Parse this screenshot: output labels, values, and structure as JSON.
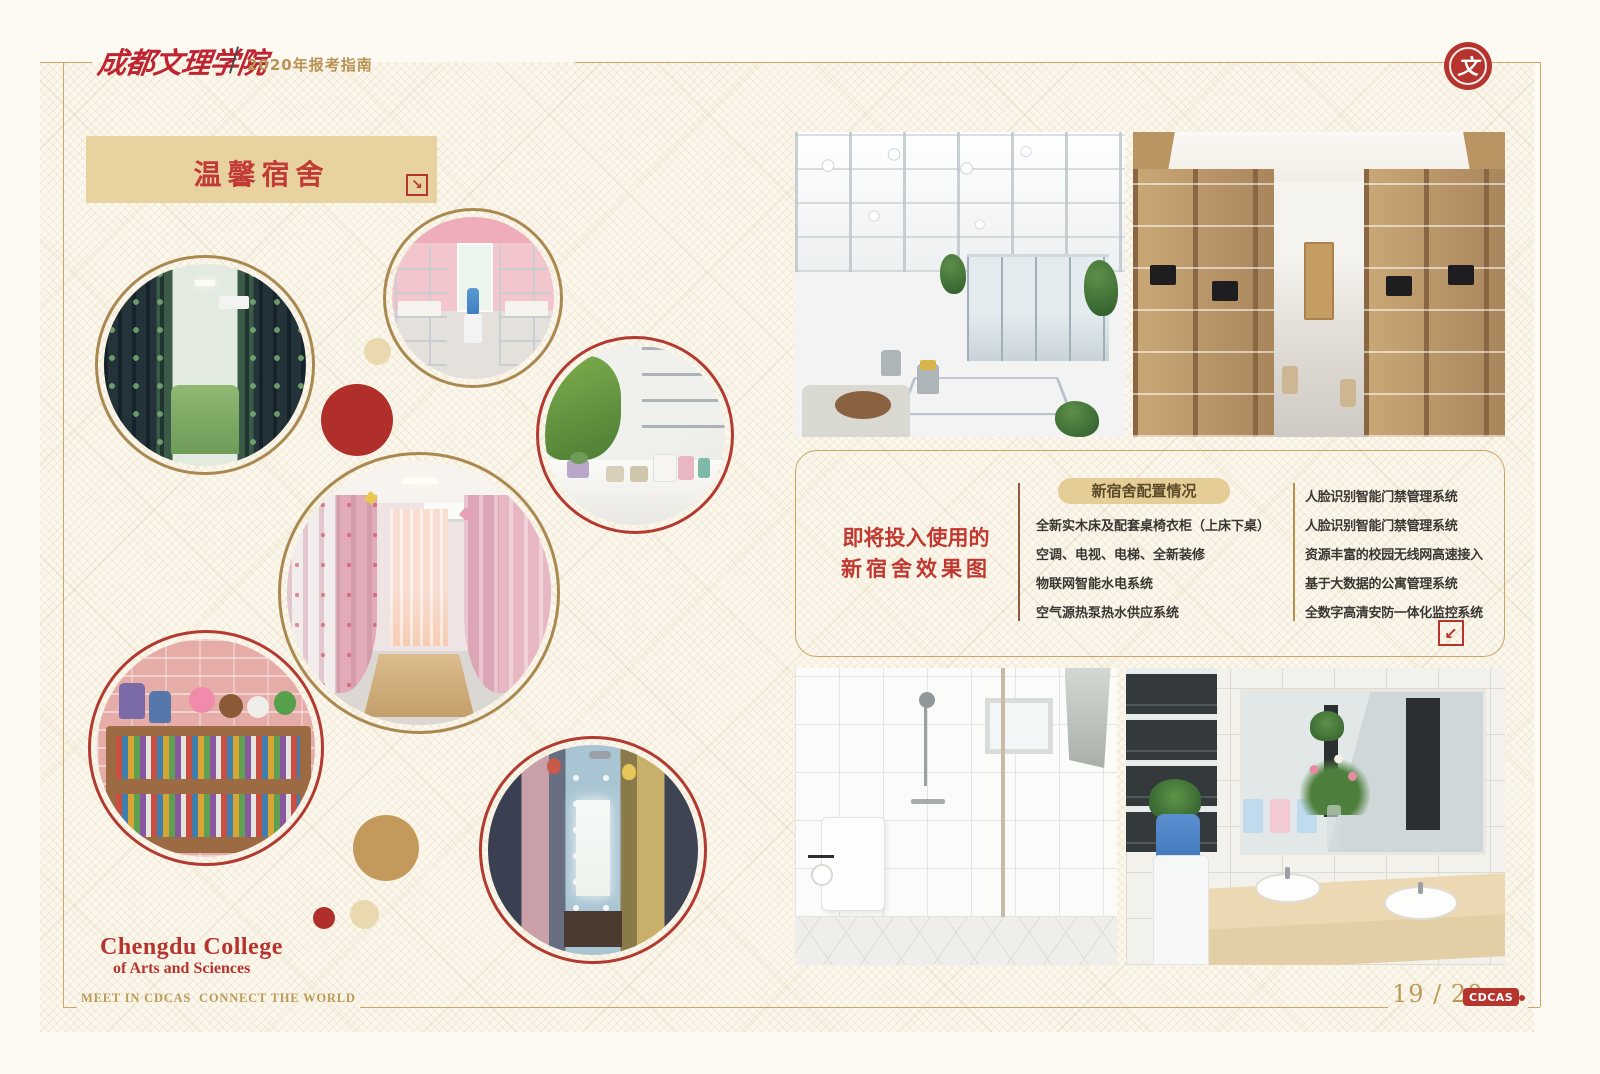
{
  "header": {
    "school_name": "成都文理学院",
    "guide_label": "2020年报考指南"
  },
  "section": {
    "title": "温馨宿舍"
  },
  "info_box": {
    "intro_line1": "即将投入使用的",
    "intro_line2": "新宿舍效果图",
    "badge": "新宿舍配置情况",
    "left_items": [
      "全新实木床及配套桌椅衣柜（上床下桌）",
      "空调、电视、电梯、全新装修",
      "物联网智能水电系统",
      "空气源热泵热水供应系统"
    ],
    "right_items": [
      "人脸识别智能门禁管理系统",
      "人脸识别智能门禁管理系统",
      "资源丰富的校园无线网高速接入",
      "基于大数据的公寓管理系统",
      "全数字高清安防一体化监控系统"
    ]
  },
  "footer": {
    "college_name_line1": "Chengdu College",
    "college_name_line2": "of Arts and Sciences",
    "slogan": "MEET IN CDCAS  CONNECT THE WORLD",
    "page_number": "19 / 20",
    "logo_badge": "CDCAS"
  },
  "icons": {
    "banner_corner_arrow": "↘",
    "info_box_corner_arrow": "↙",
    "seal_glyph": "文"
  },
  "colors": {
    "accent_red": "#b5342e",
    "gold": "#c9a66a",
    "banner_bg": "#e8d3a0",
    "badge_bg": "#e5cd97",
    "page_bg": "#fbf7ec",
    "text_dark": "#3a3632"
  }
}
